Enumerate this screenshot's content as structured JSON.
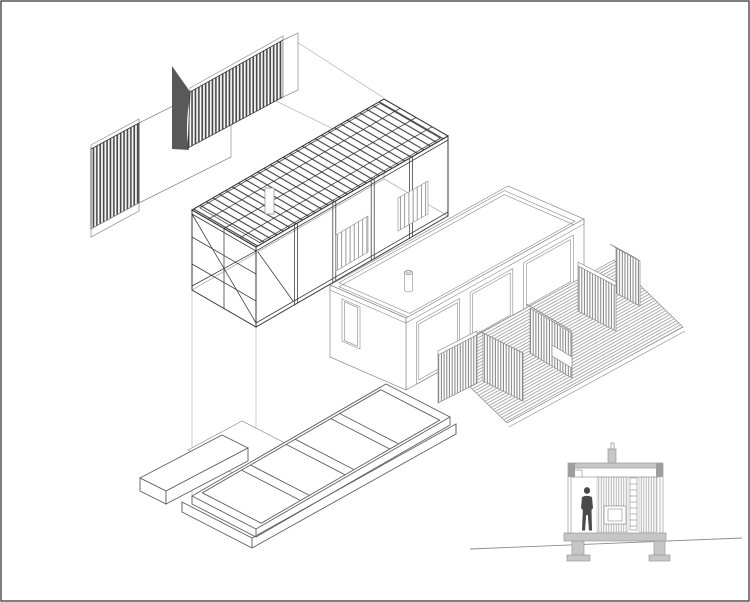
{
  "title": "Exploded axonometric drawing of a small timber-framed house with entry deck, plus cross-section inset with human figure",
  "drawing_type": "architectural exploded axonometric + section",
  "background": "#ffffff",
  "colors": {
    "border": "#3a3a3a",
    "line_dark": "#383838",
    "line_mid": "#8a8a8a",
    "line_light": "#9a9a9a",
    "line_found": "#5f5f5f",
    "guide": "#ababab",
    "hatch_dark": "#4a4a4a",
    "hatch_mid": "#7d7d7d",
    "hatch_light": "#aeaeae",
    "joist": "#3f3f3f",
    "deck_line": "#8c8c8c",
    "stud": "#828282",
    "flap": "#595959",
    "slab": "#c6c6c6",
    "block": "#9e9e9e",
    "figure": "#4a4a4a"
  },
  "components": {
    "axonometric": {
      "cladding_walls": "dark vertical-board cladding panels exploded to upper left",
      "solid_flap": "dark solid wall return at end of upper cladding panel",
      "roof_frame": "long rectangular structural frame with roof joists, columns and X-bracing, exploded upward",
      "roof_penetration": "small flue opening in joist field",
      "building_volume": "single-storey volume with parapet flat roof and chimney",
      "facade_openings": "wireframe door and window openings on front facade",
      "deck_floor": "diagonally hatched timber deck",
      "deck_screens": "vertical-slat privacy screens around deck",
      "foundation_platform": "floor platform with perimeter and cross beams on plinth, exploded downward",
      "terrace_slab": "thin flat landing plate",
      "entry_step": "low rectangular step slab",
      "projection_lines": "thin vertical and diagonal explosion guide lines"
    },
    "section_inset": {
      "roof_slab": "grey roof band with end blocks",
      "chimney": "flue stub above roof",
      "interior_walls": "light vertical-board hatched walls",
      "window": "small framed opening in middle wall",
      "ladder": "rung strip between walls",
      "human_figure": "standing person silhouette",
      "floor_slab": "grey floor band",
      "footings": "two concrete footings below floor",
      "ground_line": "sloping grade line"
    }
  }
}
